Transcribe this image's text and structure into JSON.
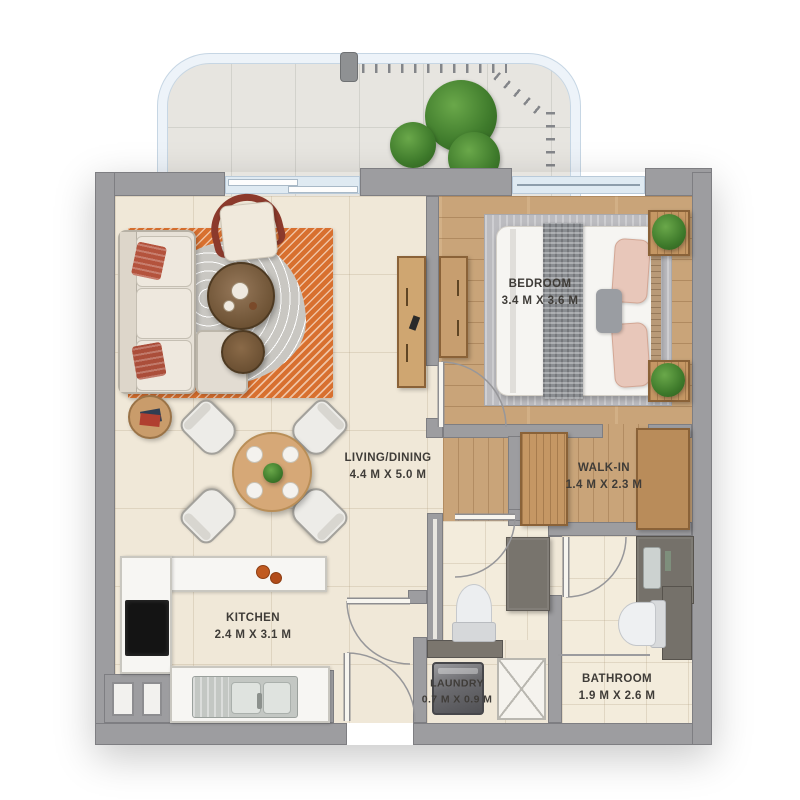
{
  "rooms": {
    "living_dining": {
      "label": "LIVING/DINING",
      "dimensions": "4.4 M X 5.0 M"
    },
    "bedroom": {
      "label": "BEDROOM",
      "dimensions": "3.4 M X 3.6 M"
    },
    "walk_in": {
      "label": "WALK-IN",
      "dimensions": "1.4 M X 2.3 M"
    },
    "kitchen": {
      "label": "KITCHEN",
      "dimensions": "2.4 M X 3.1 M"
    },
    "laundry": {
      "label": "LAUNDRY",
      "dimensions": "0.7 M X 0.9 M"
    },
    "bathroom": {
      "label": "BATHROOM",
      "dimensions": "1.9 M X 2.6 M"
    }
  },
  "colors": {
    "wall": "#9d9da0",
    "floor_tile": "#f0e8d8",
    "floor_wood": "#c9a479",
    "balcony_floor": "#e7e5e0",
    "glass": "#dfeaf2",
    "accent_rug": "#d8702f",
    "text": "#3f3c38"
  }
}
